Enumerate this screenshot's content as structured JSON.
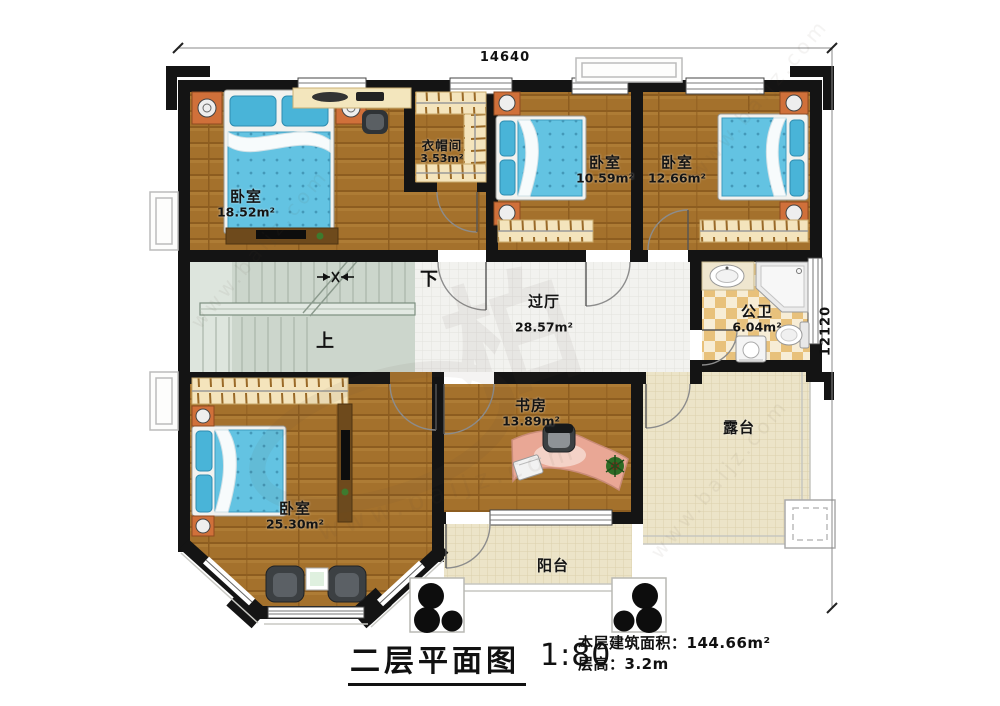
{
  "dimensions": {
    "top": "14640",
    "right": "12120"
  },
  "rooms": {
    "bedroom_top_left": {
      "name": "卧室",
      "area": "18.52m²"
    },
    "cloakroom": {
      "name": "衣帽间",
      "area": "3.53m²"
    },
    "bedroom_top_middle": {
      "name": "卧室",
      "area": "10.59m²"
    },
    "bedroom_top_right": {
      "name": "卧室",
      "area": "12.66m²"
    },
    "hallway": {
      "name": "过厅",
      "area": "28.57m²"
    },
    "bathroom": {
      "name": "公卫",
      "area": "6.04m²"
    },
    "bedroom_bottom_left": {
      "name": "卧室",
      "area": "25.30m²"
    },
    "study": {
      "name": "书房",
      "area": "13.89m²"
    },
    "terrace": {
      "name": "露台"
    },
    "balcony": {
      "name": "阳台"
    }
  },
  "stairs": {
    "down": "下",
    "up": "上"
  },
  "title_block": {
    "title": "二层平面图",
    "scale": "1:80",
    "area_label": "本层建筑面积：",
    "area_value": "144.66m²",
    "height_label": "层高：",
    "height_value": "3.2m"
  },
  "watermark": {
    "site": "www.baijz.com",
    "logo": "柏"
  },
  "colors": {
    "wall": "#141414",
    "wood_floor": "#a4712c",
    "bed_blue": "#63c3e2",
    "nightstand_orange": "#d0703a",
    "bath_tile": "#e8c17b",
    "stair_green": "#ccd6cc",
    "terrace_cream": "#ece4c8"
  }
}
